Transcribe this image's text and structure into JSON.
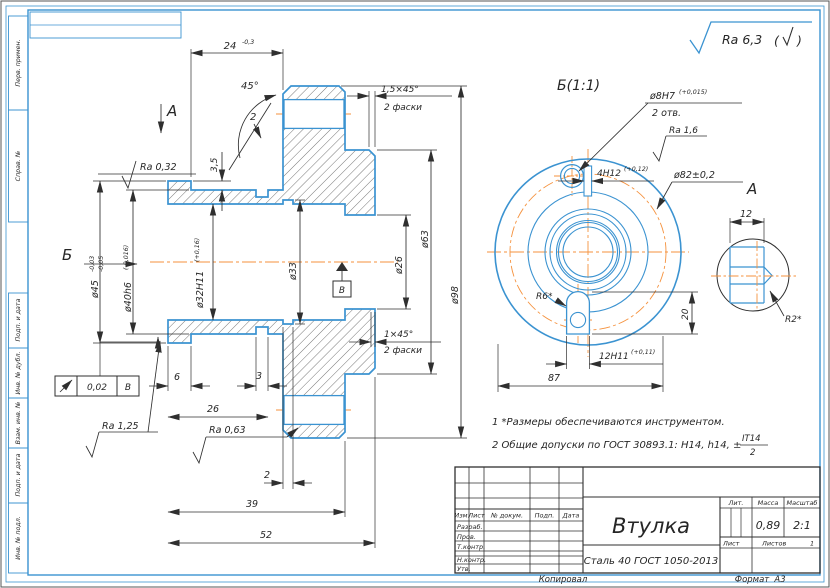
{
  "colors": {
    "contour": "#3b93d1",
    "frame": "#3b93d1",
    "centerline": "#f5923e",
    "dim": "#2f2f2f"
  },
  "left_strip": [
    "Перв. примен.",
    "Справ. №",
    "Подп. и дата",
    "Инв. № дубл.",
    "Взам. инв. №",
    "Подп. и дата",
    "Инв. № подл."
  ],
  "general_roughness": {
    "value": "Ra 6,3",
    "paren_open": "(",
    "paren_close": ")"
  },
  "main_view": {
    "dia45": "ø45",
    "dia45_up": "-0,03",
    "dia45_low": "-0,05",
    "dia40": "ø40h6",
    "dia40_tol": "(-0,016)",
    "dia32": "ø32H11",
    "dia32_tol": "(+0,16)",
    "dia33": "ø33",
    "dia26": "ø26",
    "dia63": "ø63",
    "dia98": "ø98",
    "dim24": "24",
    "dim24_tol": "-0,3",
    "dim35": "3,5",
    "ang45": "45°",
    "ch2": "2",
    "ch15": "1,5×45°",
    "ch15_note": "2 фаски",
    "ch1": "1×45°",
    "ch1_note": "2 фаски",
    "dim6": "6",
    "dim3": "3",
    "dim26": "26",
    "dim2": "2",
    "dim39": "39",
    "dim52": "52",
    "ra032": "Ra 0,32",
    "ra125": "Ra 1,25",
    "ra063": "Ra 0,63",
    "runout_val": "0,02",
    "runout_datum": "В",
    "datum": "В",
    "arrow_a": "А",
    "arrow_b": "Б"
  },
  "view_b": {
    "title": "Б(1:1)",
    "dia8": "ø8H7",
    "dia8_tol": "(+0,015)",
    "dia8_note": "2 отв.",
    "ra16": "Ra 1,6",
    "slot4": "4H12",
    "slot4_tol": "(+0,12)",
    "dia82": "ø82±0,2",
    "r6": "R6*",
    "dim20": "20",
    "slot12": "12H11",
    "slot12_tol": "(+0,11)",
    "dim87": "87",
    "label_a": "А"
  },
  "view_a": {
    "dim12": "12",
    "r2": "R2*"
  },
  "notes": {
    "line1": "1  *Размеры обеспечиваются инструментом.",
    "line2": "2  Общие допуски по ГОСТ 30893.1: H14, h14, ±",
    "frac_num": "IT14",
    "frac_den": "2"
  },
  "title_block": {
    "name": "Втулка",
    "material": "Сталь 40 ГОСТ 1050-2013",
    "lit": "Лит.",
    "mass_label": "Масса",
    "scale_label": "Масштаб",
    "mass": "0,89",
    "scale": "2:1",
    "sheet_label": "Лист",
    "sheets_label": "Листов",
    "sheets": "1",
    "col_izm": "Изм.",
    "col_list": "Лист",
    "col_doc": "№ докум.",
    "col_sign": "Подп.",
    "col_date": "Дата",
    "row_razrab": "Разраб.",
    "row_prov": "Пров.",
    "row_tkontr": "Т.контр.",
    "row_nkontr": "Н.контр.",
    "row_utv": "Утв.",
    "kopiroval": "Копировал",
    "format_label": "Формат",
    "format": "А3"
  }
}
